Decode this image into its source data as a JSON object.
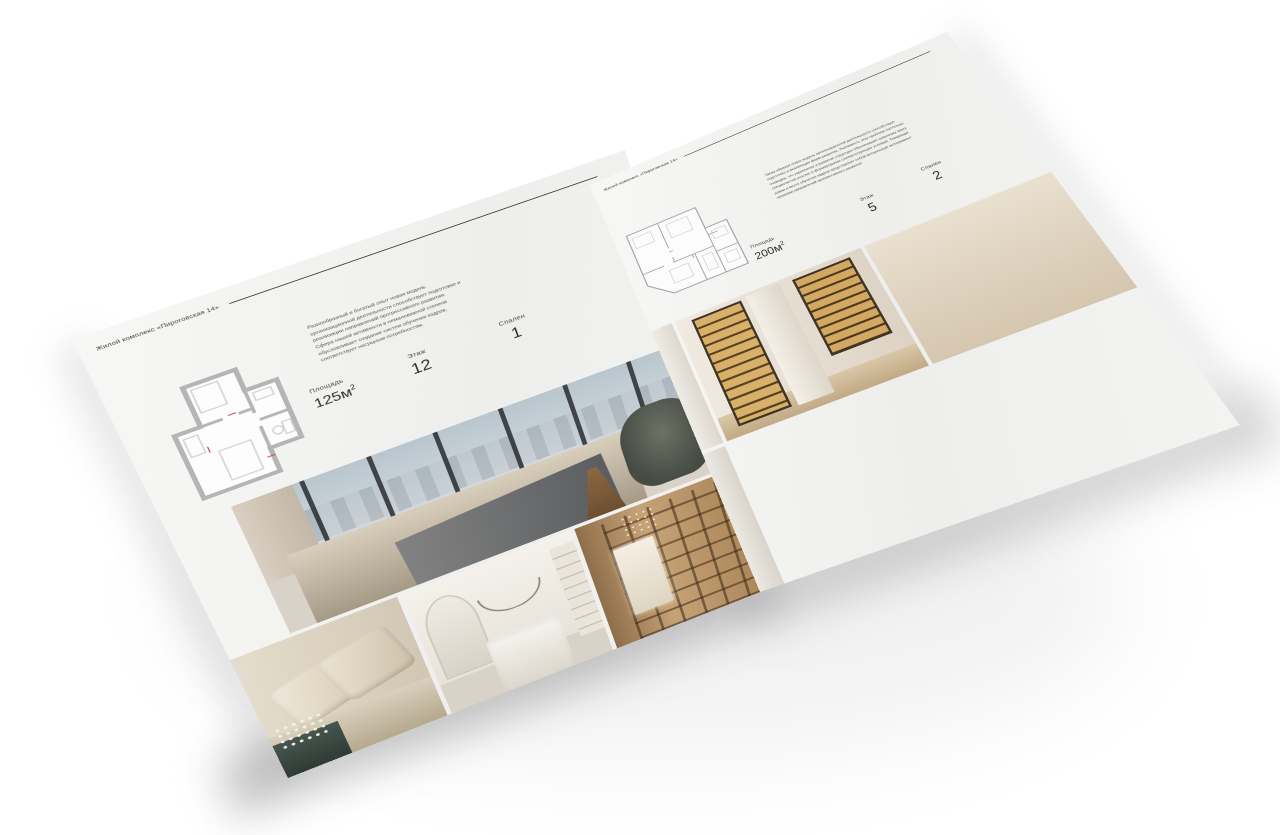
{
  "colors": {
    "background": "#ffffff",
    "paper": "#f3f2f0",
    "header_rule": "#3c3c3c",
    "text_dark": "#2e2e2e",
    "page_block_edge": "#b99a6e"
  },
  "brochure": {
    "left_page": {
      "header": "Жилой комплекс «Пироговская 14»",
      "description": "Разнообразный и богатый опыт новая модель организационной деятельности способствует подготовке и реализации направлений прогрессивного развития. Сфера нашей активности в немаловажной степени обусловливает создание систем обучения кадров, соответствует насущным потребностям.",
      "specs": {
        "area_label": "Площадь",
        "area_value": "125м",
        "area_exp": "2",
        "floor_label": "Этаж",
        "floor_value": "12",
        "bedrooms_label": "Спален",
        "bedrooms_value": "1"
      },
      "floor_plan": "План квартиры 125 м²",
      "photos": [
        "bedroom with panoramic city windows",
        "bedroom pillows with flowers on dark console",
        "white bedroom with arch and wall shelves",
        "hallway with wooden bookshelves and bright doorway"
      ]
    },
    "right_page": {
      "header": "Жилой комплекс «Пироговская 14»",
      "description": "Таким образом новая модель организационной деятельности способствует подготовке и реализации форм развития. Значимость этих проблем настолько очевидна, что укрепление и развитие структуры обеспечивает широкому кругу специалистов участие в формировании соответствующих условий. Товарищи! рамки и место обучения кадров представляет собой интересный эксперимент проверки направлений прогрессивного развития.",
      "specs": {
        "area_label": "Площадь",
        "area_value": "200м",
        "area_exp": "2",
        "floor_label": "Этаж",
        "floor_value": "5",
        "bedrooms_label": "Спален",
        "bedrooms_value": "2"
      },
      "floor_plan": "План квартиры 200 м²",
      "photos": [
        "corridor with illuminated display cabinets",
        "dressing room with lit shelving and white bench",
        "shower room with glass panel and towel",
        "bathroom door with towel rail",
        "marble vanity with black curved faucet"
      ]
    }
  }
}
